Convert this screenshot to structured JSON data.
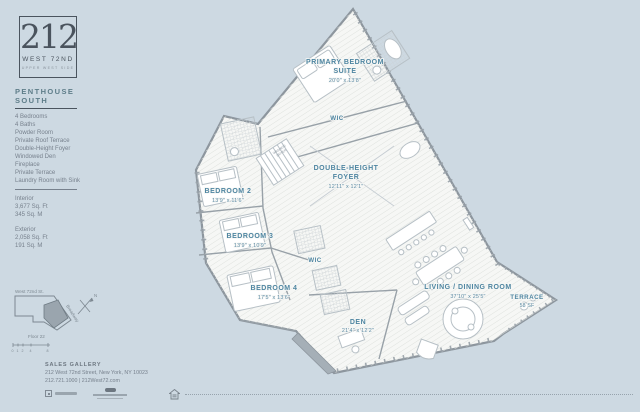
{
  "branding": {
    "number": "212",
    "street": "WEST 72ND",
    "tagline": "UPPER WEST SIDE"
  },
  "sidebar": {
    "unit_line1": "PENTHOUSE",
    "unit_line2": "SOUTH",
    "features": [
      "4 Bedrooms",
      "4 Baths",
      "Powder Room",
      "Private Roof Terrace",
      "Double-Height Foyer",
      "Windowed Den",
      "Fireplace",
      "Private Terrace",
      "Laundry Room with Sink"
    ],
    "interior": {
      "label": "Interior",
      "sqft": "3,677 Sq. Ft",
      "sqm": "345 Sq. M"
    },
    "exterior": {
      "label": "Exterior",
      "sqft": "2,058 Sq. Ft",
      "sqm": "191 Sq. M"
    },
    "keyplan": {
      "street": "West 72nd St.",
      "avenue": "Broadway",
      "floor": "Floor 22",
      "compass": "N",
      "scale": [
        "0",
        "1",
        "2",
        "4",
        "8"
      ]
    }
  },
  "floorplan": {
    "accent": "#4e85a1",
    "rooms": [
      {
        "line1": "PRIMARY BEDROOM",
        "line2": "SUITE",
        "dim": "20'0\" x 13'8\""
      },
      {
        "line1": "WIC",
        "dim": ""
      },
      {
        "line1": "DOUBLE-HEIGHT",
        "line2": "FOYER",
        "dim": "12'11\" x 12'1\""
      },
      {
        "line1": "BEDROOM 2",
        "dim": "13'9\" x 11'6\""
      },
      {
        "line1": "BEDROOM 3",
        "dim": "13'9\" x 10'9\""
      },
      {
        "line1": "WIC",
        "dim": ""
      },
      {
        "line1": "BEDROOM 4",
        "dim": "17'5\" x 13'6\""
      },
      {
        "line1": "DEN",
        "dim": "21'4\" x 12'2\""
      },
      {
        "line1": "LIVING / DINING ROOM",
        "dim": "37'10\" x 25'5\""
      },
      {
        "line1": "TERRACE",
        "dim": "58 SF"
      },
      {
        "line1": "WASHER/",
        "line2": "DRYER",
        "dim": ""
      }
    ]
  },
  "footer": {
    "gallery_label": "SALES GALLERY",
    "address": "212 West 72nd Street, New York, NY 10023",
    "contact": "212.721.1000  |  212West72.com"
  }
}
